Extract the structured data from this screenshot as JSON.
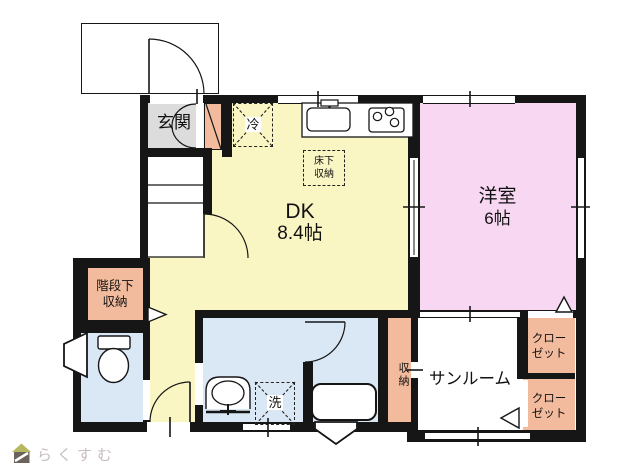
{
  "rooms": {
    "entrance": "玄関",
    "dining_kitchen": "DK",
    "dining_kitchen_size": "8.4帖",
    "western_room": "洋室",
    "western_room_size": "6帖",
    "sunroom": "サンルーム",
    "closet_upper_line1": "クロー",
    "closet_upper_line2": "ゼット",
    "closet_lower_line1": "クロー",
    "closet_lower_line2": "ゼット",
    "storage": "収納",
    "under_stairs_line1": "階段下",
    "under_stairs_line2": "収納",
    "underfloor_line1": "床下",
    "underfloor_line2": "収納",
    "refrigerator": "冷",
    "washing_machine": "洗"
  },
  "colors": {
    "wall": "#161616",
    "dk_floor": "#faf6c4",
    "western_room_floor": "#f7d7f2",
    "storage_fill": "#f3bb9d",
    "wet_area_fill": "#dae8f5",
    "entrance_fill": "#dcdcdc"
  },
  "logo": {
    "text": "らくすむ"
  }
}
